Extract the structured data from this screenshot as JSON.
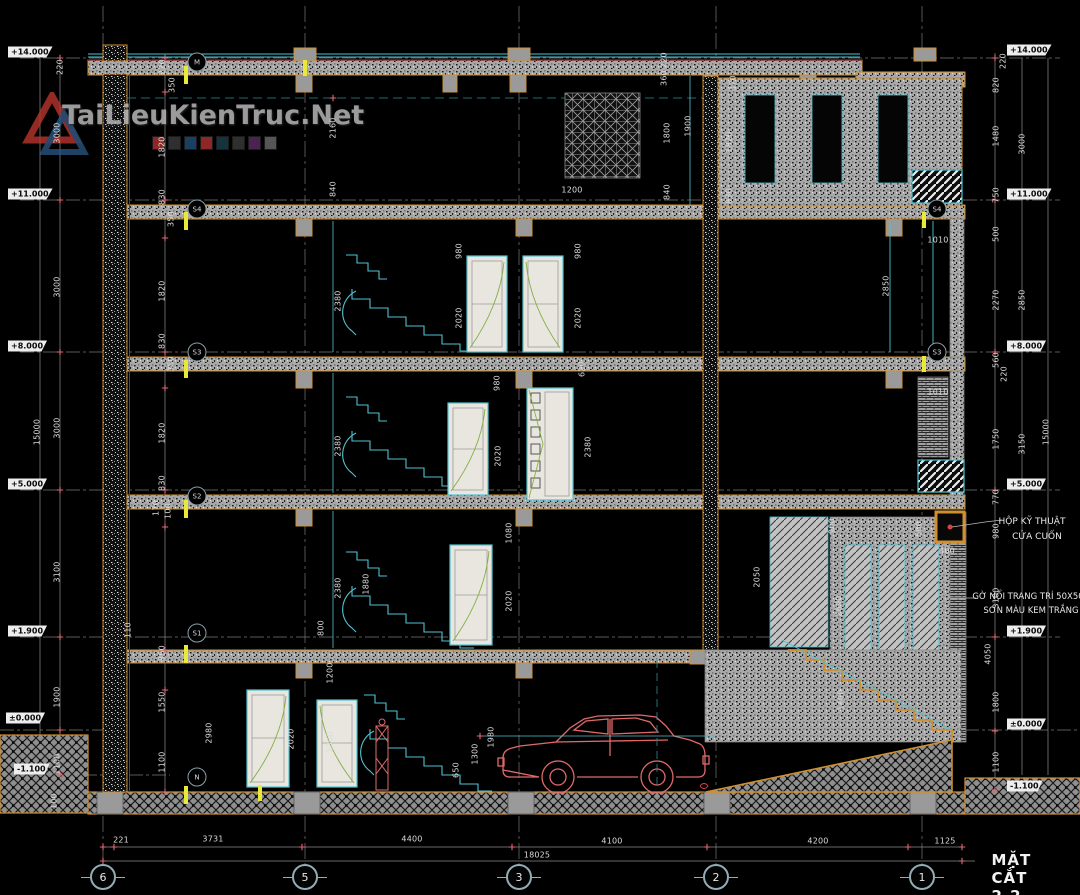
{
  "title": "MẶT CẮT 2-2",
  "watermark": {
    "text": "TaiLieuKienTruc.Net",
    "squares": [
      "#b03030",
      "#3a3a3a",
      "#1d4f7a",
      "#b03030",
      "#16404e",
      "#3a3a3a",
      "#5c2a62",
      "#6a6a6a"
    ]
  },
  "annotations": {
    "tech_line1": "HỘP KỸ THUẬT",
    "tech_line2": "CỬA CUỐN",
    "trim_line1": "GỜ NỔI TRANG TRÍ 50X50",
    "trim_line2": "SƠN MÀU KEM TRẮNG"
  },
  "colors": {
    "accent_orange": "#d09030",
    "accent_cyan": "#4ec3d3",
    "car_red": "#e06a6a",
    "tick_red": "#e06878",
    "marker_yellow": "#e9e93a"
  },
  "grid_axis_y": 877,
  "grid_bubbles": [
    {
      "label": "6",
      "x": 103
    },
    {
      "label": "5",
      "x": 305
    },
    {
      "label": "3",
      "x": 519
    },
    {
      "label": "2",
      "x": 716
    },
    {
      "label": "1",
      "x": 922
    }
  ],
  "elevation_markers": [
    {
      "label": "+14.000",
      "x": 8,
      "y": 52
    },
    {
      "label": "+11.000",
      "x": 8,
      "y": 194
    },
    {
      "label": "+8.000",
      "x": 8,
      "y": 346
    },
    {
      "label": "+5.000",
      "x": 8,
      "y": 484
    },
    {
      "label": "+1.900",
      "x": 8,
      "y": 631
    },
    {
      "label": "±0.000",
      "x": 6,
      "y": 718
    },
    {
      "label": "-1.100",
      "x": 14,
      "y": 769
    },
    {
      "label": "+14.000",
      "x": 1007,
      "y": 50
    },
    {
      "label": "+11.000",
      "x": 1007,
      "y": 194
    },
    {
      "label": "+8.000",
      "x": 1007,
      "y": 346
    },
    {
      "label": "+5.000",
      "x": 1007,
      "y": 484
    },
    {
      "label": "+1.900",
      "x": 1007,
      "y": 631
    },
    {
      "label": "±0.000",
      "x": 1007,
      "y": 724
    },
    {
      "label": "-1.100",
      "x": 1007,
      "y": 786
    }
  ],
  "section_markers": [
    {
      "label": "M",
      "x": 197,
      "y": 62
    },
    {
      "label": "S4",
      "x": 197,
      "y": 209
    },
    {
      "label": "S3",
      "x": 197,
      "y": 352
    },
    {
      "label": "S2",
      "x": 197,
      "y": 496
    },
    {
      "label": "S1",
      "x": 197,
      "y": 633
    },
    {
      "label": "N",
      "x": 197,
      "y": 777
    },
    {
      "label": "S4",
      "x": 937,
      "y": 209
    },
    {
      "label": "S3",
      "x": 937,
      "y": 352
    }
  ],
  "bottom_dims": [
    {
      "t": "221",
      "x": 121,
      "y": 840
    },
    {
      "t": "3731",
      "x": 213,
      "y": 839
    },
    {
      "t": "4400",
      "x": 412,
      "y": 839
    },
    {
      "t": "4100",
      "x": 612,
      "y": 841
    },
    {
      "t": "4200",
      "x": 818,
      "y": 841
    },
    {
      "t": "1125",
      "x": 945,
      "y": 841
    },
    {
      "t": "18025",
      "x": 537,
      "y": 855
    }
  ],
  "dim_labels": [
    [
      "15000",
      37,
      432,
      1
    ],
    [
      "3000",
      57,
      133,
      1
    ],
    [
      "3000",
      57,
      287,
      1
    ],
    [
      "3000",
      57,
      428,
      1
    ],
    [
      "3100",
      57,
      572,
      1
    ],
    [
      "1900",
      57,
      697,
      1
    ],
    [
      "1100",
      57,
      764,
      1
    ],
    [
      "100",
      54,
      801,
      1
    ],
    [
      "220",
      60,
      67,
      1
    ],
    [
      "220",
      162,
      67,
      1
    ],
    [
      "350",
      172,
      85,
      1
    ],
    [
      "1820",
      162,
      147,
      1
    ],
    [
      "830",
      162,
      197,
      1
    ],
    [
      "350",
      171,
      219,
      1
    ],
    [
      "1820",
      162,
      291,
      1
    ],
    [
      "830",
      162,
      341,
      1
    ],
    [
      "350",
      171,
      364,
      1
    ],
    [
      "1820",
      162,
      433,
      1
    ],
    [
      "830",
      162,
      483,
      1
    ],
    [
      "170",
      156,
      508,
      1
    ],
    [
      "100",
      168,
      511,
      1
    ],
    [
      "850",
      162,
      653,
      1
    ],
    [
      "1550",
      162,
      702,
      1
    ],
    [
      "1100",
      162,
      762,
      1
    ],
    [
      "110",
      128,
      630,
      1
    ],
    [
      "2160",
      333,
      128,
      1
    ],
    [
      "840",
      333,
      189,
      1
    ],
    [
      "2380",
      338,
      301,
      1
    ],
    [
      "2380",
      338,
      446,
      1
    ],
    [
      "2380",
      338,
      588,
      1
    ],
    [
      "1880",
      366,
      584,
      1
    ],
    [
      "1200",
      330,
      673,
      1
    ],
    [
      "1800",
      330,
      742,
      1
    ],
    [
      "2020",
      291,
      739,
      1
    ],
    [
      "2980",
      209,
      733,
      1
    ],
    [
      "800",
      321,
      628,
      1
    ],
    [
      "980",
      459,
      251,
      1
    ],
    [
      "2020",
      459,
      318,
      1
    ],
    [
      "980",
      578,
      251,
      1
    ],
    [
      "2020",
      578,
      318,
      1
    ],
    [
      "980",
      497,
      383,
      1
    ],
    [
      "2020",
      498,
      456,
      1
    ],
    [
      "620",
      582,
      369,
      1
    ],
    [
      "2380",
      588,
      447,
      1
    ],
    [
      "1080",
      509,
      533,
      1
    ],
    [
      "2020",
      509,
      601,
      1
    ],
    [
      "1200",
      572,
      190,
      0
    ],
    [
      "220",
      664,
      60,
      1
    ],
    [
      "360",
      664,
      78,
      1
    ],
    [
      "1800",
      667,
      133,
      1
    ],
    [
      "840",
      667,
      192,
      1
    ],
    [
      "1900",
      688,
      126,
      1
    ],
    [
      "370",
      733,
      83,
      1
    ],
    [
      "1820",
      729,
      142,
      1
    ],
    [
      "830",
      729,
      196,
      1
    ],
    [
      "2850",
      886,
      286,
      1
    ],
    [
      "1010",
      938,
      240,
      0
    ],
    [
      "1010",
      938,
      392,
      0
    ],
    [
      "2050",
      757,
      577,
      1
    ],
    [
      "900",
      832,
      526,
      1
    ],
    [
      "2690",
      839,
      606,
      1
    ],
    [
      "1400",
      841,
      700,
      1
    ],
    [
      "500",
      919,
      529,
      1
    ],
    [
      "400",
      947,
      551,
      0
    ],
    [
      "650",
      456,
      770,
      1
    ],
    [
      "1300",
      475,
      754,
      1
    ],
    [
      "1980",
      491,
      737,
      1
    ],
    [
      "220",
      1003,
      61,
      1
    ],
    [
      "820",
      996,
      85,
      1
    ],
    [
      "1480",
      996,
      136,
      1
    ],
    [
      "750",
      996,
      195,
      1
    ],
    [
      "500",
      996,
      234,
      1
    ],
    [
      "2270",
      996,
      300,
      1
    ],
    [
      "560",
      996,
      360,
      1
    ],
    [
      "220",
      1004,
      374,
      1
    ],
    [
      "1750",
      996,
      439,
      1
    ],
    [
      "770",
      996,
      497,
      1
    ],
    [
      "980",
      996,
      531,
      1
    ],
    [
      "3100",
      996,
      598,
      1
    ],
    [
      "4050",
      988,
      654,
      1
    ],
    [
      "1800",
      996,
      702,
      1
    ],
    [
      "1100",
      996,
      762,
      1
    ],
    [
      "3000",
      1022,
      144,
      1
    ],
    [
      "2850",
      1022,
      300,
      1
    ],
    [
      "3150",
      1022,
      444,
      1
    ],
    [
      "15000",
      1046,
      432,
      1
    ]
  ],
  "yellow_flags": [
    {
      "x": 186,
      "y": 66,
      "h": 18
    },
    {
      "x": 186,
      "y": 212,
      "h": 18
    },
    {
      "x": 186,
      "y": 360,
      "h": 18
    },
    {
      "x": 186,
      "y": 500,
      "h": 18
    },
    {
      "x": 186,
      "y": 645,
      "h": 18
    },
    {
      "x": 186,
      "y": 786,
      "h": 18
    },
    {
      "x": 305,
      "y": 60,
      "h": 16
    },
    {
      "x": 924,
      "y": 212,
      "h": 16
    },
    {
      "x": 924,
      "y": 356,
      "h": 16
    },
    {
      "x": 260,
      "y": 785,
      "h": 16
    }
  ]
}
